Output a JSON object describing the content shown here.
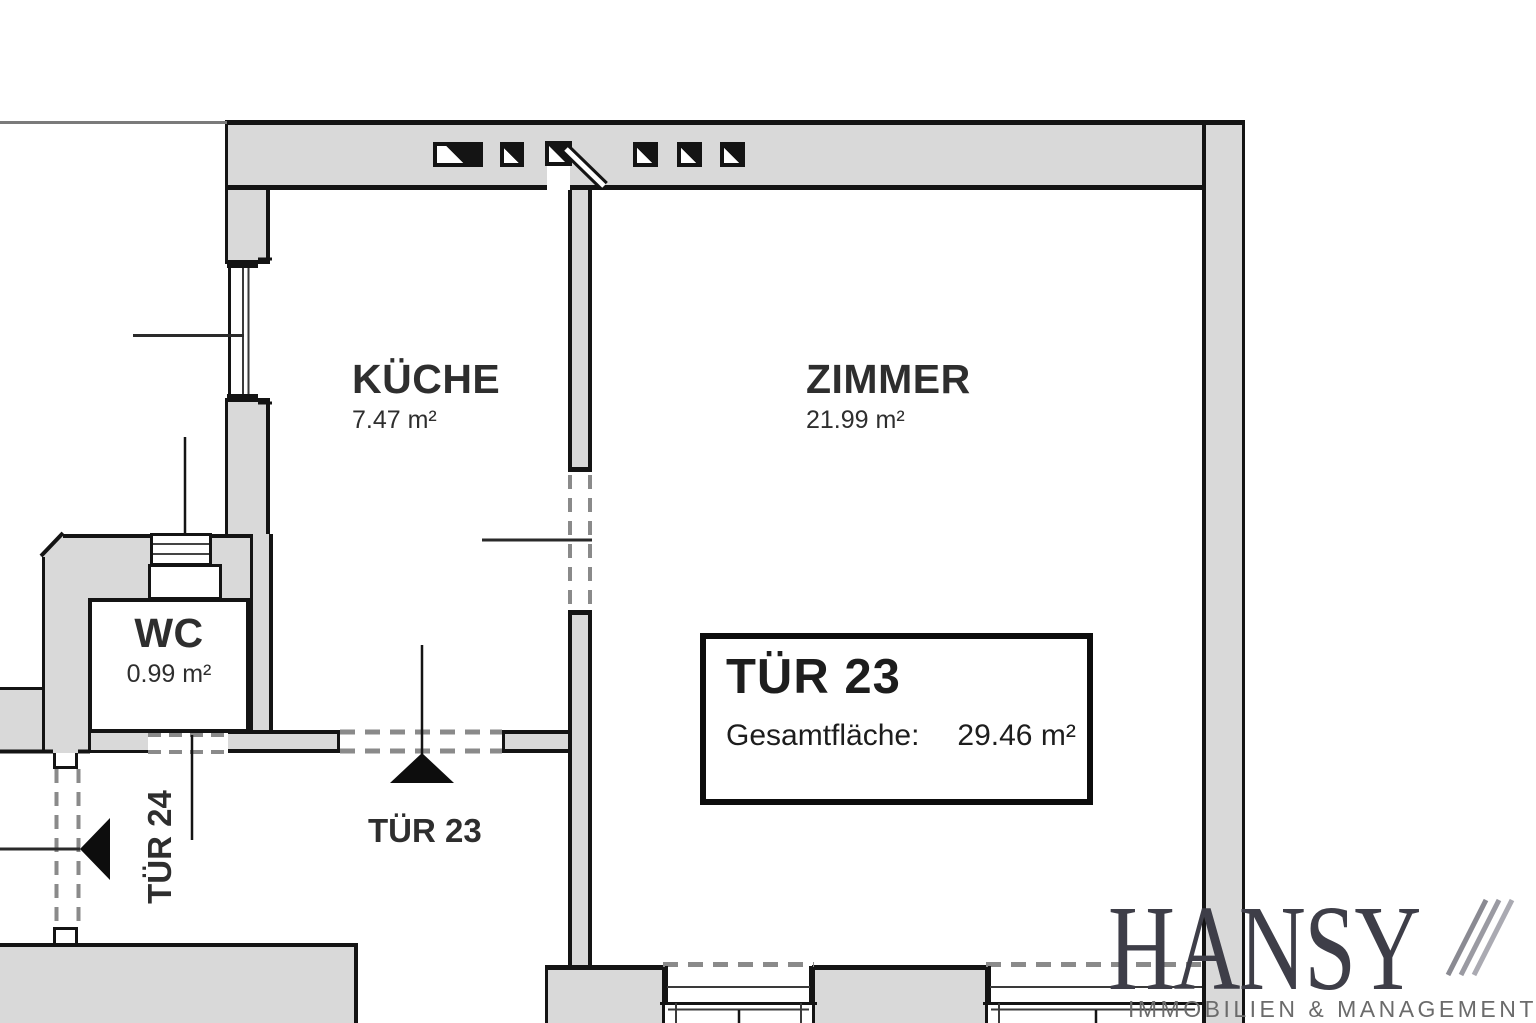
{
  "plan": {
    "rooms": [
      {
        "id": "kueche",
        "name": "KÜCHE",
        "area": "7.47 m²"
      },
      {
        "id": "zimmer",
        "name": "ZIMMER",
        "area": "21.99 m²"
      },
      {
        "id": "wc",
        "name": "WC",
        "area": "0.99 m²"
      }
    ],
    "doors": [
      {
        "id": "tuer23",
        "label": "TÜR 23"
      },
      {
        "id": "tuer24",
        "label": "TÜR 24"
      }
    ],
    "info_box": {
      "title": "TÜR 23",
      "label": "Gesamtfläche:",
      "value": "29.46 m²"
    }
  },
  "logo": {
    "name": "HANSY",
    "subtitle": "IMMOBILIEN & MANAGEMENT",
    "url_text": "www.hansy.at"
  },
  "colors": {
    "wall_fill": "#d9d9d9",
    "line": "#141414",
    "dash": "#8a8a8a",
    "logo_text": "#3e3e48",
    "logo_subtitle": "#6b6b6b",
    "logo_url": "#b3b3b3",
    "label_text": "#2e2e2e"
  }
}
